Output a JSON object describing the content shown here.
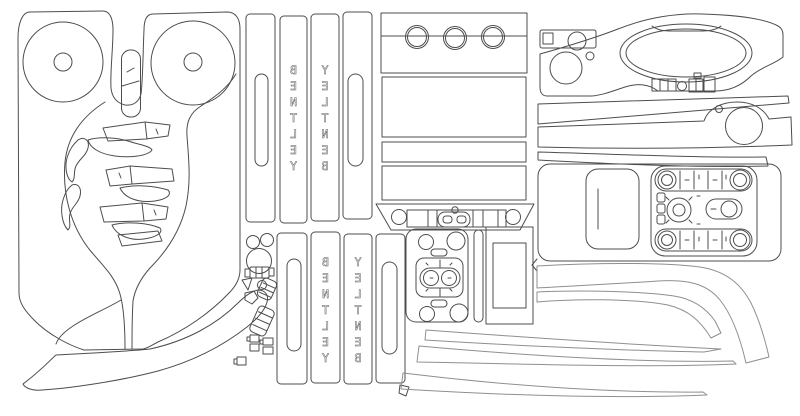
{
  "sheet": {
    "background": "#ffffff",
    "line_color": "#4d4d4d",
    "soft_line_color": "#8f8f8f",
    "width_px": 800,
    "height_px": 416
  },
  "branding": {
    "word": "BENTLEY",
    "letters": [
      "B",
      "E",
      "N",
      "T",
      "L",
      "E",
      "Y"
    ],
    "style": "mirrored vertical outline lettering",
    "strip_count": 4
  }
}
